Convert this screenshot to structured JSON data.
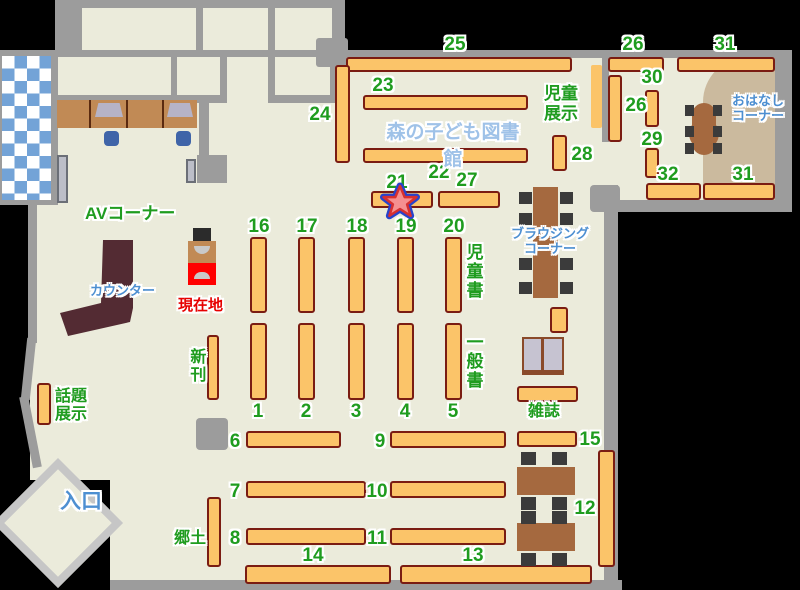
{
  "title": "森の子ども図書館",
  "labels": {
    "av_corner": "AVコーナー",
    "counter": "カウンター",
    "current_location": "現在地",
    "new_books": "新刊",
    "topic_line1": "話題",
    "topic_line2": "展示",
    "entrance": "入口",
    "local_books": "郷土",
    "children_books": "児童書",
    "general_books": "一般書",
    "magazines": "雑誌",
    "browsing_line1": "ブラウジング",
    "browsing_line2": "コーナー",
    "children_display_line1": "児童",
    "children_display_line2": "展示",
    "story_line1": "おはなし",
    "story_line2": "コーナー"
  },
  "numbers": {
    "n1": "1",
    "n2": "2",
    "n3": "3",
    "n4": "4",
    "n5": "5",
    "n6": "6",
    "n7": "7",
    "n8": "8",
    "n9": "9",
    "n10": "10",
    "n11": "11",
    "n12": "12",
    "n13": "13",
    "n14": "14",
    "n15": "15",
    "n16": "16",
    "n17": "17",
    "n18": "18",
    "n19": "19",
    "n20": "20",
    "n21": "21",
    "n22": "22",
    "n23": "23",
    "n24": "24",
    "n25": "25",
    "n26": "26",
    "n26b": "26",
    "n27": "27",
    "n28": "28",
    "n29": "29",
    "n30": "30",
    "n31": "31",
    "n31b": "31",
    "n32": "32"
  },
  "colors": {
    "floor": "#EBEBDB",
    "wall": "#9C9C9C",
    "shelf": "#FBC469",
    "shelf-border": "#7A1C12",
    "green": "#1F9C1F",
    "blue": "#4D8FD1",
    "titleblue": "#9FC2E8",
    "tan": "#CBBA9E",
    "table": "#A5693F",
    "counter": "#532B33",
    "chair": "#3B3B3B",
    "checker": "#73A3D7",
    "red": "#E60000",
    "kioskred": "#FF0000",
    "desk": "#C18A55",
    "door": "#BCBEC8",
    "seatblue": "#3F64A8",
    "starfill": "#F59090",
    "starin": "#D63030",
    "starout": "#2743CC"
  }
}
